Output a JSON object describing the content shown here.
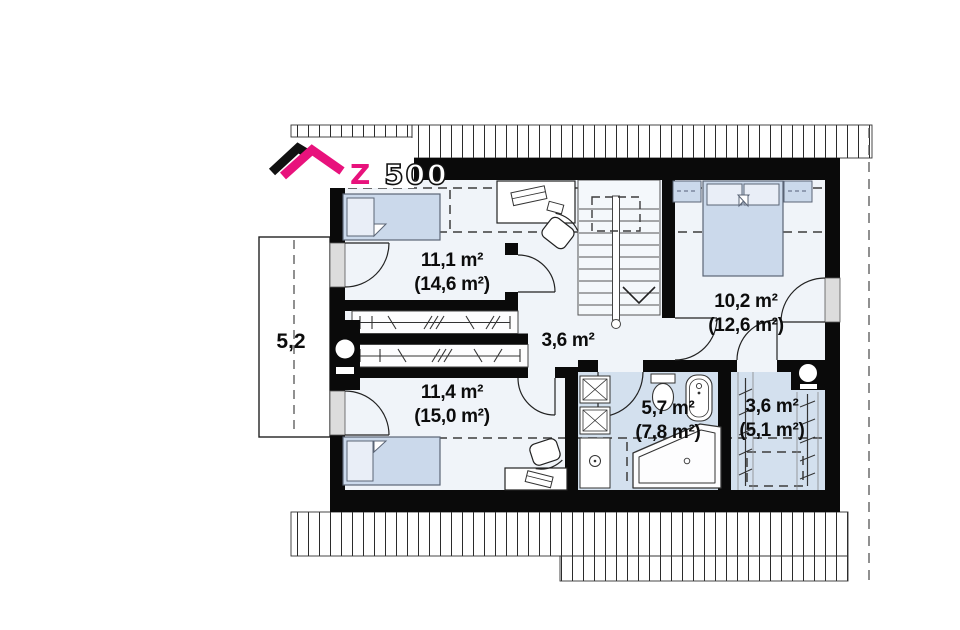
{
  "logo": {
    "brand_z": "Z",
    "brand_rest": "500",
    "accent_pink": "#e8127c"
  },
  "rooms": [
    {
      "name": "bedroom-top-left",
      "area": "11,1 m²",
      "floor_area": "(14,6 m²)"
    },
    {
      "name": "hallway",
      "area": "3,6 m²",
      "floor_area": ""
    },
    {
      "name": "bedroom-right",
      "area": "10,2 m²",
      "floor_area": "(12,6 m²)"
    },
    {
      "name": "bedroom-bottom-left",
      "area": "11,4 m²",
      "floor_area": "(15,0 m²)"
    },
    {
      "name": "bathroom",
      "area": "5,7 m²",
      "floor_area": "(7,8 m²)"
    },
    {
      "name": "wardrobe-room",
      "area": "3,6 m²",
      "floor_area": "(5,1 m²)"
    }
  ],
  "balcony": {
    "width_label": "5,2"
  },
  "colors": {
    "wall": "#0a0a0a",
    "floor": "#f0f4f9",
    "wet_room_floor": "#d3e0ee",
    "furniture_blue": "#cbd9eb",
    "accent_pink": "#e8127c"
  }
}
